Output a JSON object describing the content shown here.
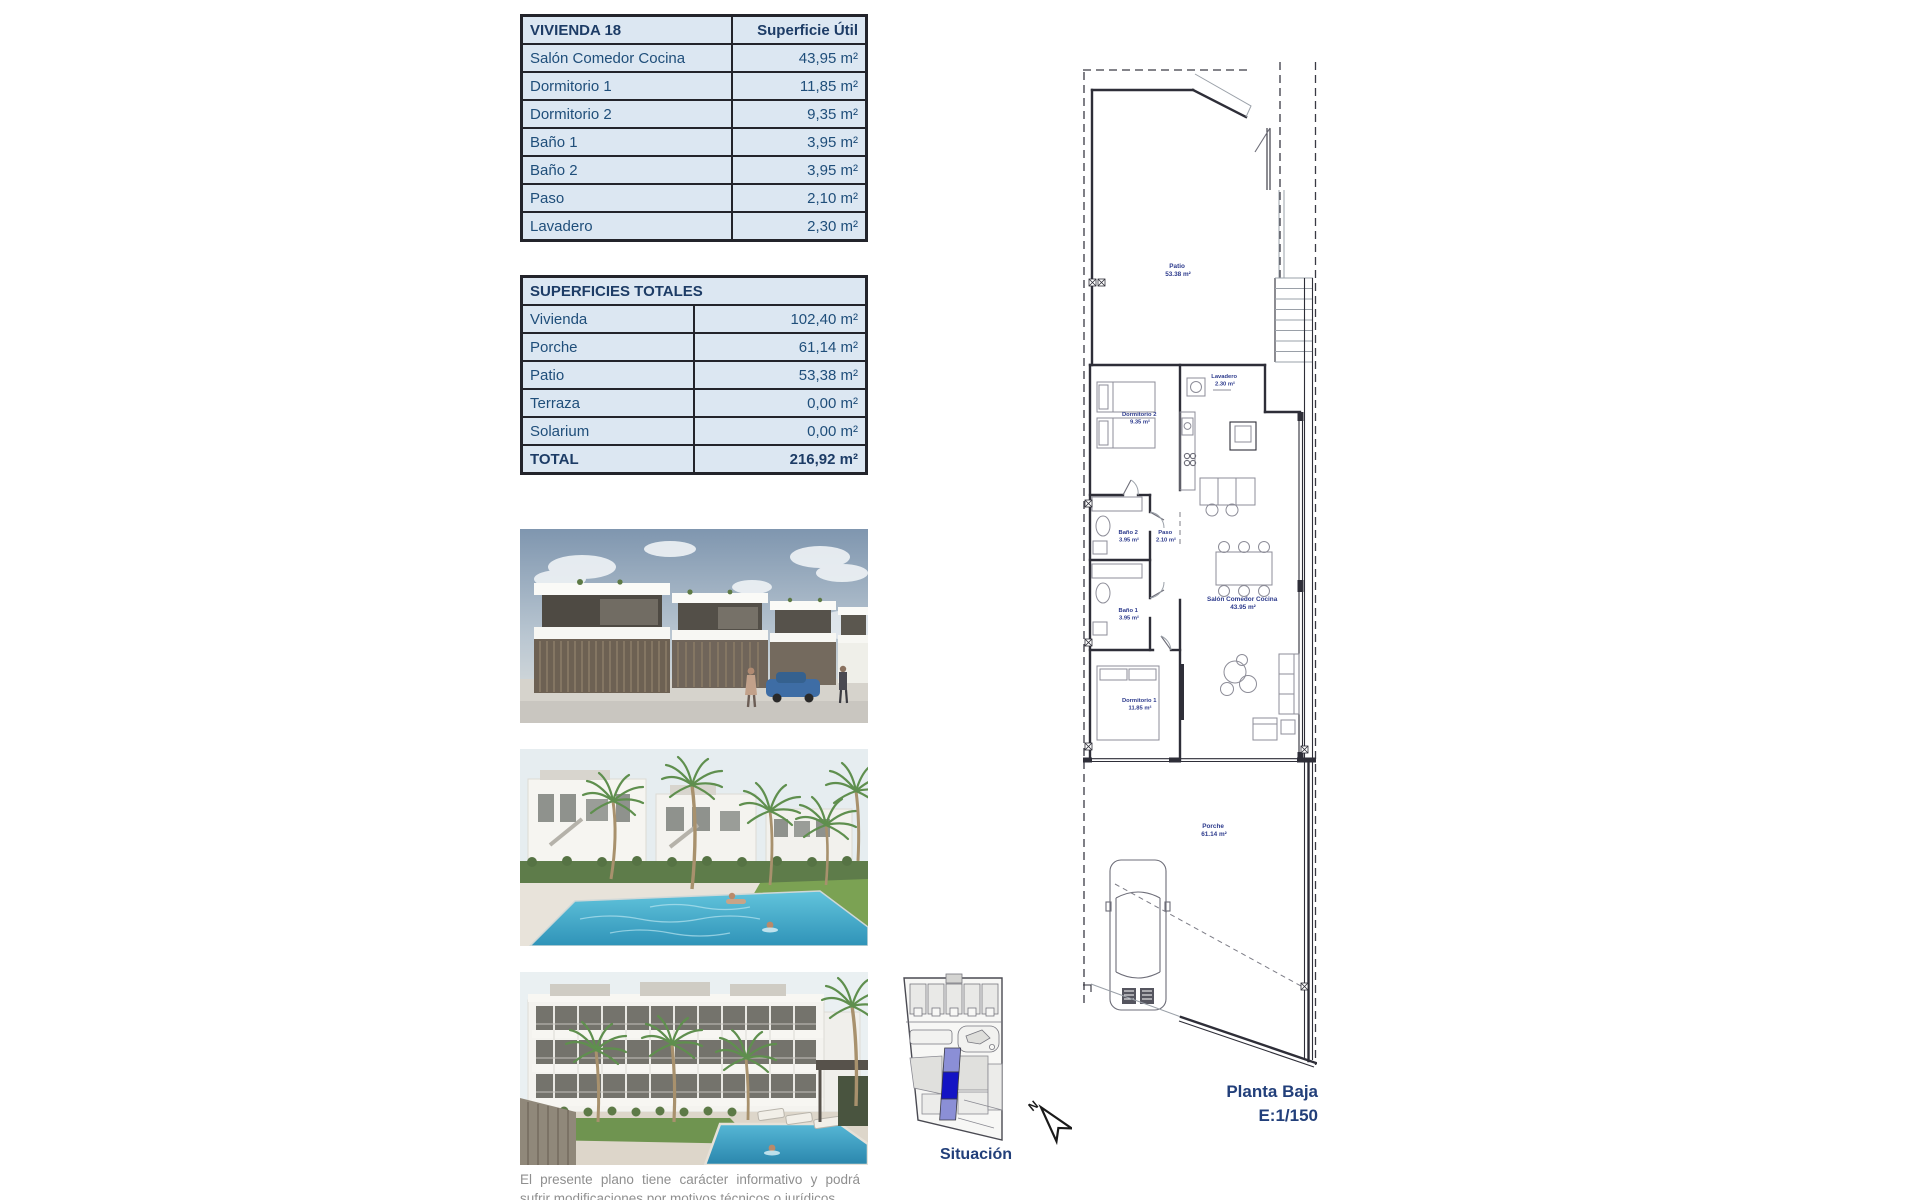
{
  "vivienda_table": {
    "title": "VIVIENDA 18",
    "header_right": "Superficie Útil",
    "rows": [
      {
        "label": "Salón Comedor Cocina",
        "value": "43,95 m²"
      },
      {
        "label": "Dormitorio 1",
        "value": "11,85 m²"
      },
      {
        "label": "Dormitorio 2",
        "value": "9,35 m²"
      },
      {
        "label": "Baño 1",
        "value": "3,95 m²"
      },
      {
        "label": "Baño 2",
        "value": "3,95 m²"
      },
      {
        "label": "Paso",
        "value": "2,10 m²"
      },
      {
        "label": "Lavadero",
        "value": "2,30 m²"
      }
    ]
  },
  "totales_table": {
    "title": "SUPERFICIES TOTALES",
    "rows": [
      {
        "label": "Vivienda",
        "value": "102,40 m²"
      },
      {
        "label": "Porche",
        "value": "61,14 m²"
      },
      {
        "label": "Patio",
        "value": "53,38 m²"
      },
      {
        "label": "Terraza",
        "value": "0,00 m²"
      },
      {
        "label": "Solarium",
        "value": "0,00 m²"
      }
    ],
    "total": {
      "label": "TOTAL",
      "value": "216,92 m²"
    }
  },
  "floor_plan": {
    "rooms": [
      {
        "name": "Patio",
        "area": "53.38 m²"
      },
      {
        "name": "Lavadero",
        "area": "2.30 m²"
      },
      {
        "name": "Dormitorio 2",
        "area": "9.35 m²"
      },
      {
        "name": "Baño 2",
        "area": "3.95 m²"
      },
      {
        "name": "Paso",
        "area": "2.10 m²"
      },
      {
        "name": "Baño 1",
        "area": "3.95 m²"
      },
      {
        "name": "Salón Comedor Cocina",
        "area": "43.95 m²"
      },
      {
        "name": "Dormitorio 1",
        "area": "11.85 m²"
      },
      {
        "name": "Porche",
        "area": "61.14 m²"
      }
    ],
    "caption_line1": "Planta Baja",
    "caption_line2": "E:1/150"
  },
  "situacion": {
    "label": "Situación",
    "north": "N",
    "highlight_color": "#1414c4",
    "highlight_light": "#8b8fd6"
  },
  "disclaimer": {
    "text": "El presente plano tiene carácter informativo y podrá sufrir modificaciones por motivos técnicos o jurídicos."
  },
  "colors": {
    "table_bg": "#dce7f2",
    "table_border": "#23242b",
    "text_navy": "#1f4e7a",
    "plan_label_blue": "#2c3a8c"
  }
}
